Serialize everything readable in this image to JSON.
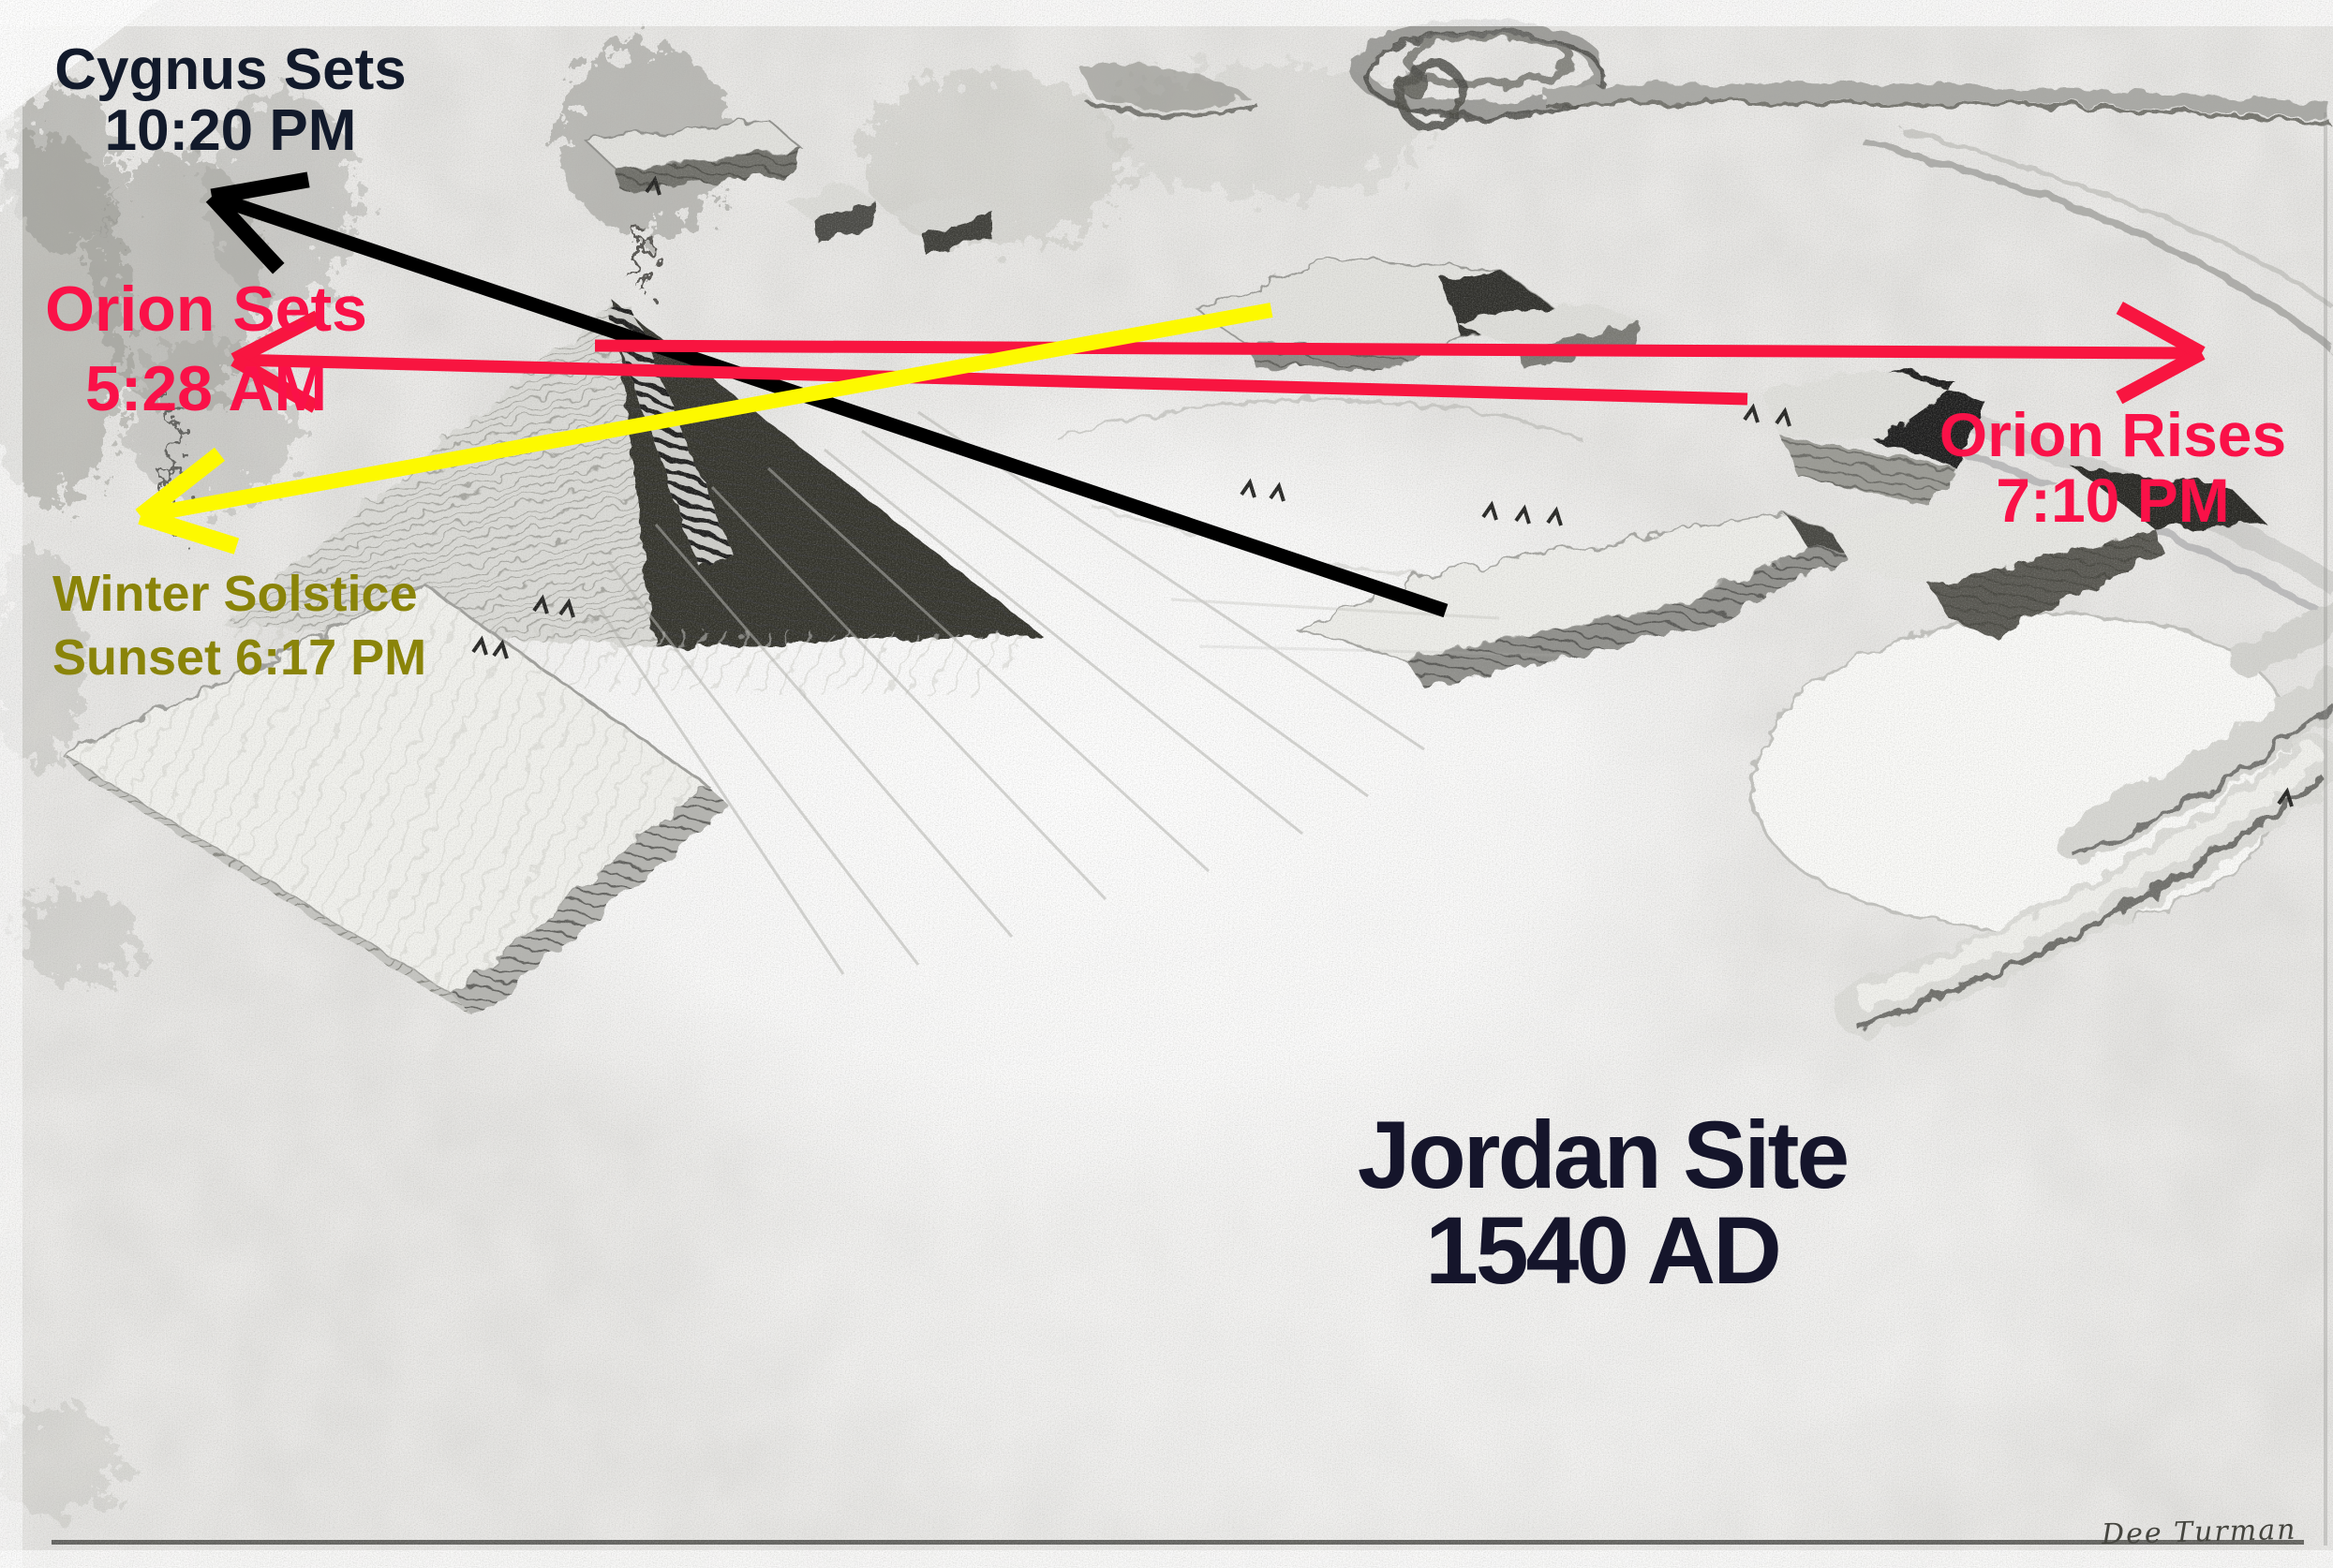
{
  "annotations": {
    "cygnus_sets": {
      "line1": "Cygnus Sets",
      "line2": "10:20 PM",
      "color": "#121a2b"
    },
    "orion_sets": {
      "line1": "Orion Sets",
      "line2": "5:28 AM",
      "color": "#fa1148"
    },
    "winter_solstice": {
      "line1": "Winter Solstice",
      "line2": "Sunset 6:17 PM",
      "color": "#8a8409"
    },
    "orion_rises": {
      "line1": "Orion Rises",
      "line2": "7:10 PM",
      "color": "#fa1148"
    },
    "site_title": {
      "line1": "Jordan Site",
      "line2": "1540 AD",
      "color": "#15152b"
    }
  },
  "signature": {
    "text": "Dee Turman",
    "color": "#45453f"
  },
  "arrows": [
    {
      "name": "cygnus-sets-arrow",
      "color": "#000000",
      "width": 15,
      "from": [
        1543,
        652
      ],
      "to": [
        226,
        210
      ],
      "head_length": 92,
      "head_half_width": 50,
      "head_stroke": 17
    },
    {
      "name": "orion-sets-arrow",
      "color": "#f81540",
      "width": 13,
      "from": [
        1865,
        426
      ],
      "to": [
        250,
        384
      ],
      "head_length": 88,
      "head_half_width": 48,
      "head_stroke": 15
    },
    {
      "name": "orion-rises-arrow",
      "color": "#f81540",
      "width": 13,
      "from": [
        635,
        369
      ],
      "to": [
        2350,
        377
      ],
      "head_length": 88,
      "head_half_width": 48,
      "head_stroke": 15
    },
    {
      "name": "winter-solstice-arrow",
      "color": "#fdf900",
      "width": 16,
      "from": [
        1357,
        331
      ],
      "to": [
        150,
        551
      ],
      "head_length": 95,
      "head_half_width": 50,
      "head_stroke": 18
    }
  ]
}
